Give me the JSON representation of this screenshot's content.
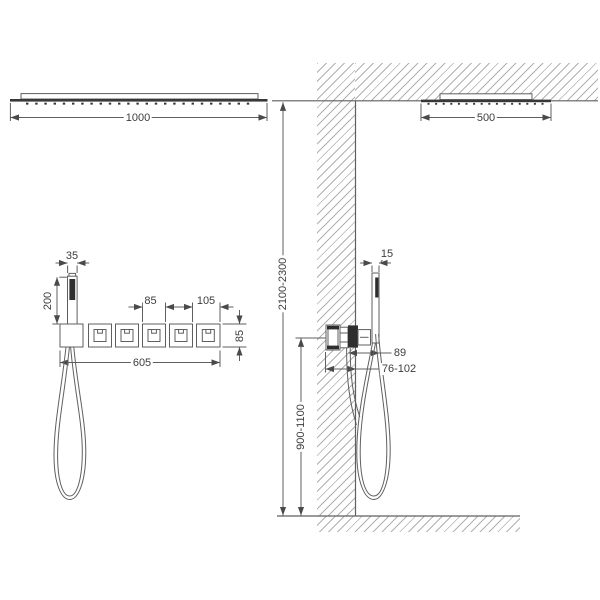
{
  "drawing": {
    "front_view": {
      "head_width": "1000",
      "handset_width": "35",
      "handset_height": "200",
      "valve_spacing": "85",
      "valve_end_spacing": "105",
      "trim_row_width": "605",
      "trim_row_height": "85"
    },
    "side_view": {
      "head_depth": "500",
      "handset_depth": "15",
      "valve_projection": "89",
      "rough_in_depth": "76-102",
      "install_height_overall": "2100-2300",
      "install_height_valve": "900-1100"
    },
    "colors": {
      "line": "#5f5f5f",
      "dark_fill": "#2e2e2e",
      "text": "#3d3d3d",
      "hatch": "#707070",
      "background": "#ffffff"
    }
  }
}
